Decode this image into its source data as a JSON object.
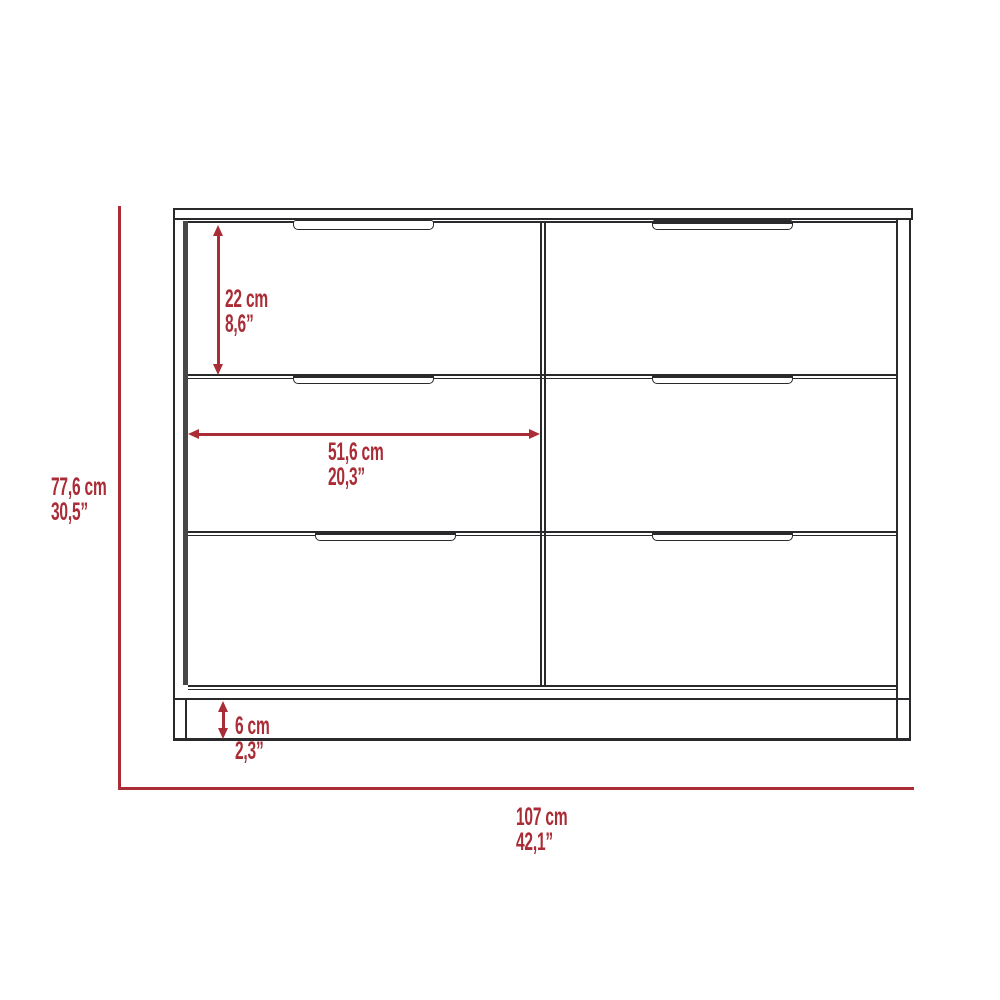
{
  "diagram": {
    "background": "#ffffff",
    "line_color": "#2a2a2c",
    "shade_color": "#474749",
    "dimension_color": "#a92c36",
    "drawer_count": 6
  },
  "labels": {
    "overall_height": {
      "cm": "77,6 cm",
      "inches": "30,5”"
    },
    "overall_width": {
      "cm": "107 cm",
      "inches": "42,1”"
    },
    "drawer_height": {
      "cm": "22 cm",
      "inches": "8,6”"
    },
    "drawer_width": {
      "cm": "51,6 cm",
      "inches": "20,3”"
    },
    "base_height": {
      "cm": "6 cm",
      "inches": "2,3”"
    }
  }
}
